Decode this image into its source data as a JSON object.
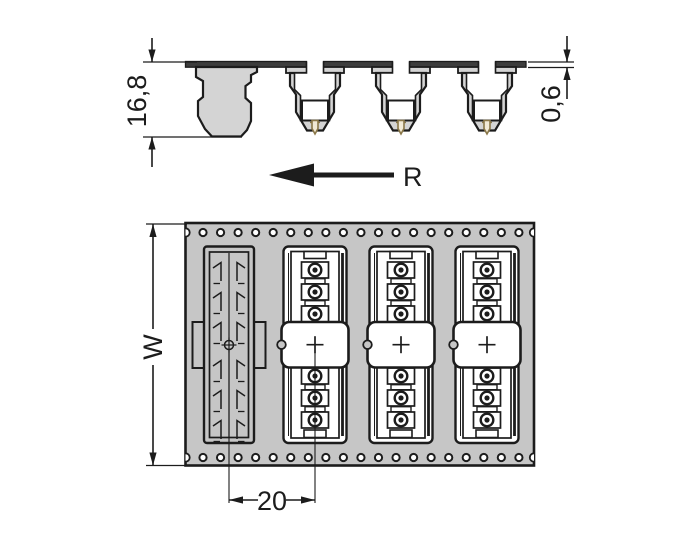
{
  "drawing": {
    "type": "technical-dimension-drawing",
    "subject": "connector-strip-on-carrier-tape",
    "views": {
      "side_view": {
        "height_dim_label": "16,8",
        "tape_thickness_dim_label": "0,6",
        "unreeling_direction_label": "R"
      },
      "plan_view": {
        "tape_width_dim_label": "W",
        "pitch_dim_label": "20"
      }
    },
    "colors": {
      "ink": "#1c1c1c",
      "tape_fill": "#c6c6c6",
      "pocket_fill": "#d4d4d4",
      "cover_strip_fill": "#3d3d3d",
      "pin_stroke": "#8a7748",
      "pin_fill": "#f2ead6",
      "background": "#ffffff"
    },
    "geometry": {
      "connector_centers_x": [
        315,
        401,
        487
      ],
      "empty_pocket_center_x": 229,
      "sprocket_holes": {
        "start_x": 203,
        "count": 19,
        "spacing": 17.55,
        "row_ys": [
          232.5,
          457.5
        ],
        "radius": 3.6
      },
      "contact_rows_y": [
        270,
        292,
        314,
        376,
        398,
        420
      ],
      "contact_separator_rows_y": [
        278.7,
        300.7,
        384.7,
        406.7
      ],
      "flag_rows_y": [
        266,
        296,
        326,
        364,
        394,
        424
      ]
    }
  }
}
